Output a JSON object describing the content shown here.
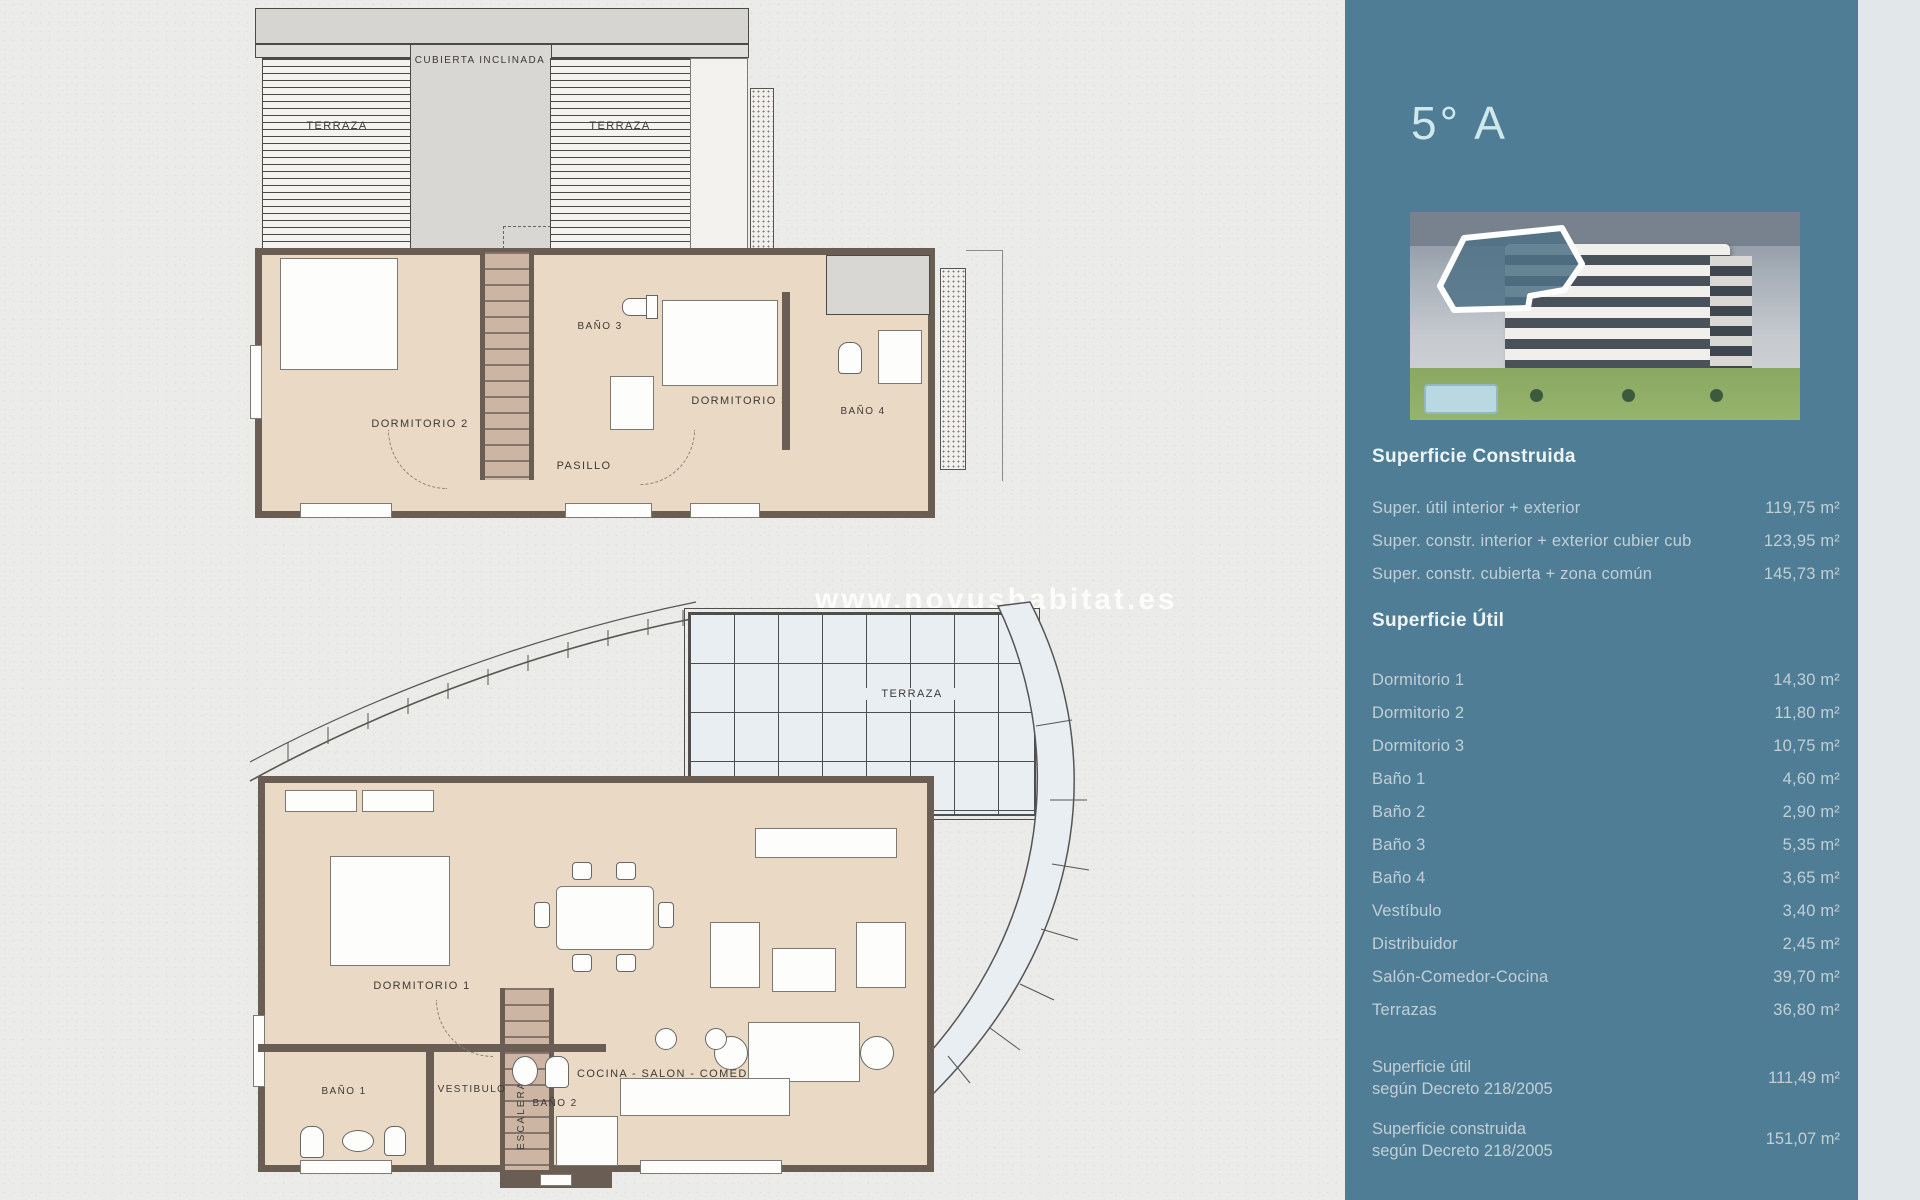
{
  "page": {
    "watermark": "www.novushabitat.es"
  },
  "colors": {
    "panel": "#4e7d95",
    "paper": "#ebebe9",
    "floor": "#ead9c4",
    "wall": "#6a5d54",
    "heading_text": "#eef5f6",
    "row_text": "#c2cfd6"
  },
  "plans": {
    "upper": {
      "labels": {
        "terraza_left": "TERRAZA",
        "cubierta": "CUBIERTA INCLINADA",
        "terraza_right": "TERRAZA",
        "dormitorio2": "DORMITORIO 2",
        "bano3": "BAÑO 3",
        "dormitorio3": "DORMITORIO 3",
        "bano4": "BAÑO 4",
        "pasillo": "PASILLO"
      }
    },
    "lower": {
      "labels": {
        "terraza": "TERRAZA",
        "dormitorio1": "DORMITORIO 1",
        "escalera": "ESCALERA",
        "cocina_salon": "COCINA - SALON - COMEDOR",
        "bano1": "BAÑO 1",
        "vestibulo": "VESTIBULO",
        "bano2": "BAÑO 2"
      }
    }
  },
  "sidebar": {
    "unit": "5° A",
    "construida": {
      "title": "Superficie Construida",
      "rows": [
        {
          "label": "Super. útil interior + exterior",
          "value": "119,75 m²"
        },
        {
          "label": "Super. constr. interior + exterior cubier cub",
          "value": "123,95 m²"
        },
        {
          "label": "Super. constr. cubierta + zona común",
          "value": "145,73 m²"
        }
      ]
    },
    "util": {
      "title": "Superficie Útil",
      "rows": [
        {
          "label": "Dormitorio 1",
          "value": "14,30 m²"
        },
        {
          "label": "Dormitorio 2",
          "value": "11,80 m²"
        },
        {
          "label": "Dormitorio 3",
          "value": "10,75 m²"
        },
        {
          "label": "Baño 1",
          "value": "4,60 m²"
        },
        {
          "label": "Baño 2",
          "value": "2,90 m²"
        },
        {
          "label": "Baño 3",
          "value": "5,35 m²"
        },
        {
          "label": "Baño 4",
          "value": "3,65 m²"
        },
        {
          "label": "Vestíbulo",
          "value": "3,40 m²"
        },
        {
          "label": "Distribuidor",
          "value": "2,45 m²"
        },
        {
          "label": "Salón-Comedor-Cocina",
          "value": "39,70 m²"
        },
        {
          "label": "Terrazas",
          "value": "36,80 m²"
        }
      ]
    },
    "totals": [
      {
        "line1": "Superficie útil",
        "line2": "según Decreto 218/2005",
        "value": "111,49 m²"
      },
      {
        "line1": "Superficie construida",
        "line2": "según Decreto 218/2005",
        "value": "151,07 m²"
      }
    ]
  }
}
